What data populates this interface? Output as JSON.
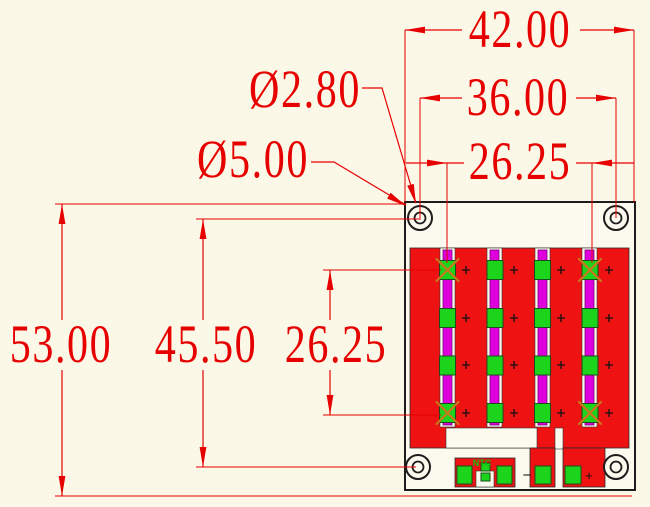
{
  "drawing": {
    "dims": {
      "width_overall": "42.00",
      "hole_pitch_h": "36.00",
      "pad_span_h": "26.25",
      "height_overall": "53.00",
      "hole_pitch_v": "45.50",
      "pad_span_v": "26.25",
      "dia_inner": "Ø2.80",
      "dia_outer": "Ø5.00"
    },
    "labels": {
      "ntc": "NTC",
      "neg": "−",
      "pos": "+"
    },
    "icons": {
      "pad_center_mark": "+",
      "unused_pad_mark": "x-cross"
    },
    "colors": {
      "bg": "#fcf8e7",
      "board": "#fcf9ee",
      "dim": "#e60000",
      "copper": "#ee1212",
      "strip": "#dd00dd",
      "pad": "#1dd41d",
      "cross": "#c9761f"
    }
  }
}
